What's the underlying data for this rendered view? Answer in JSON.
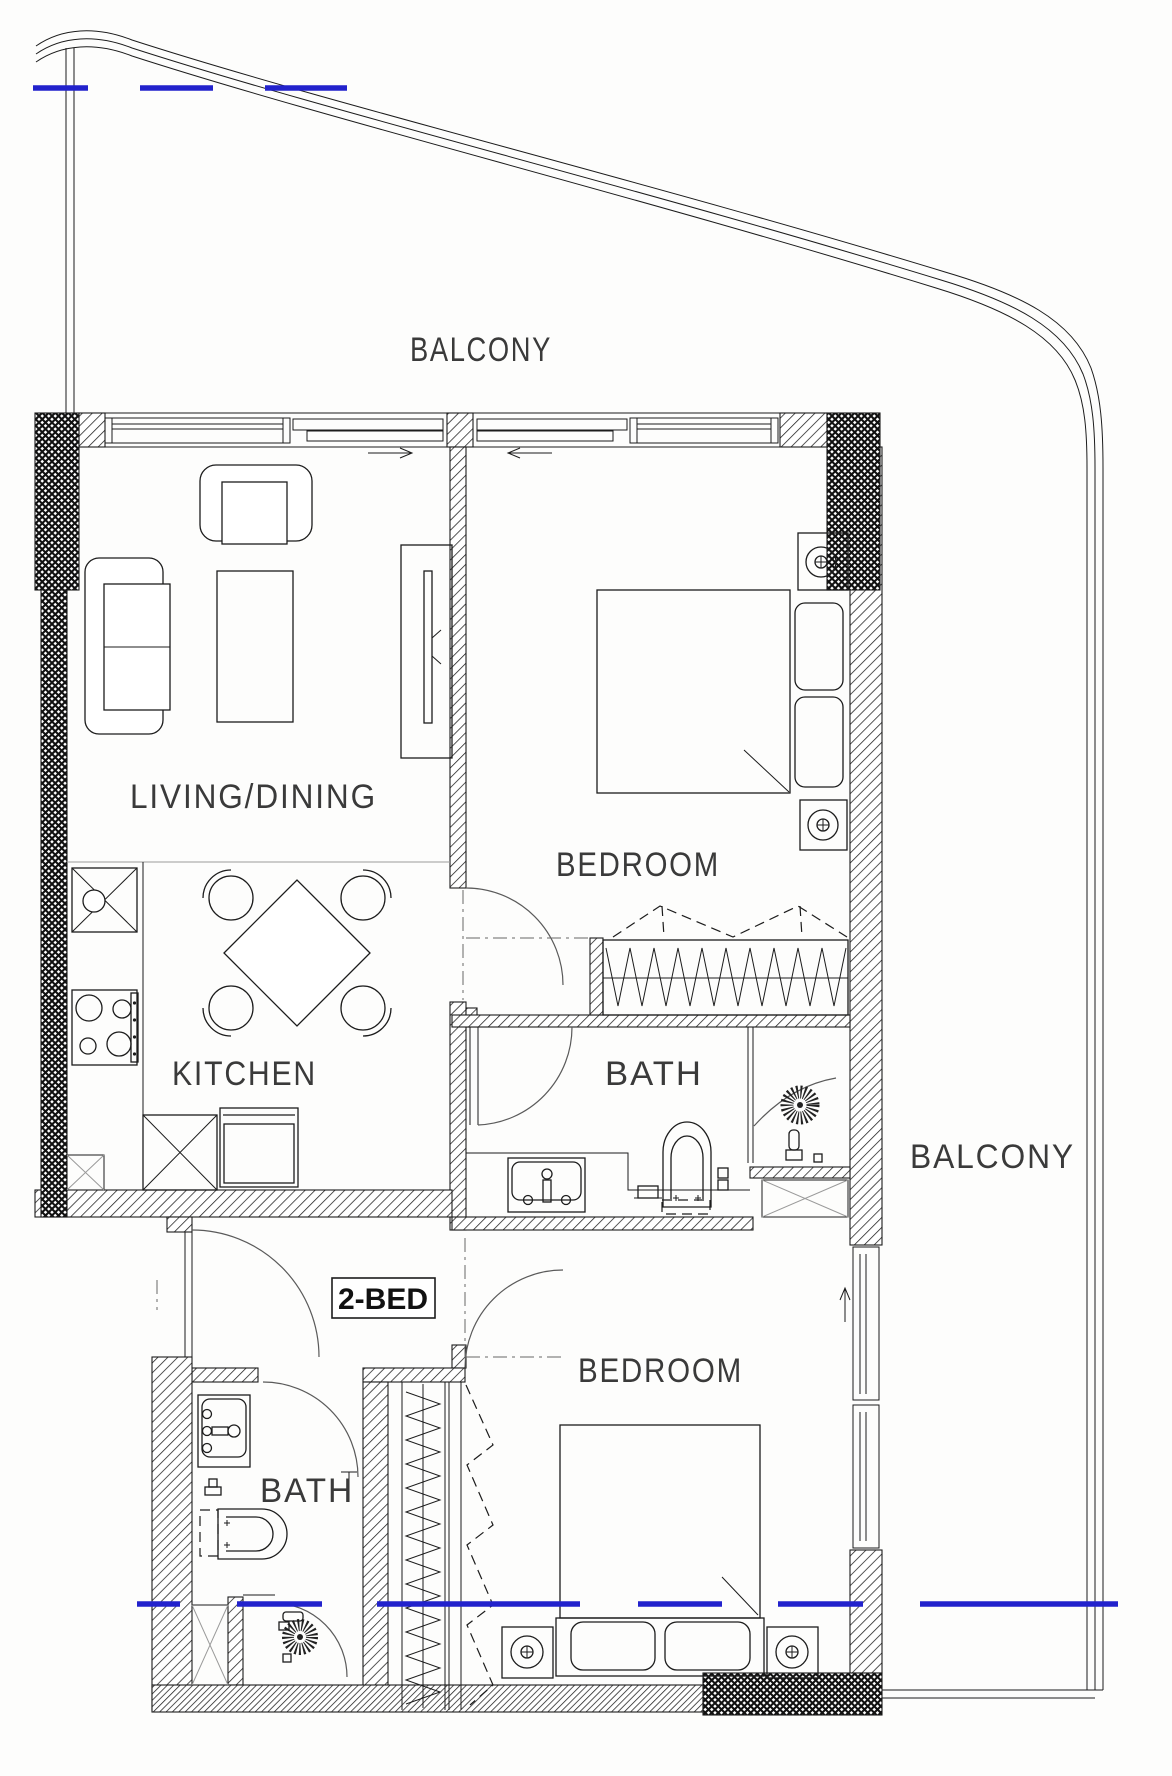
{
  "plan": {
    "unit_label": "2-BED",
    "labels": {
      "balcony_top": "BALCONY",
      "balcony_right": "BALCONY",
      "living_dining": "LIVING/DINING",
      "kitchen": "KITCHEN",
      "bedroom1": "BEDROOM",
      "bath1": "BATH",
      "bedroom2": "BEDROOM",
      "bath2": "BATH"
    },
    "colors": {
      "line": "#1c1c1c",
      "label": "#3a3a3a",
      "marker_blue": "#2222cc",
      "background": "#fdfdfc"
    }
  }
}
